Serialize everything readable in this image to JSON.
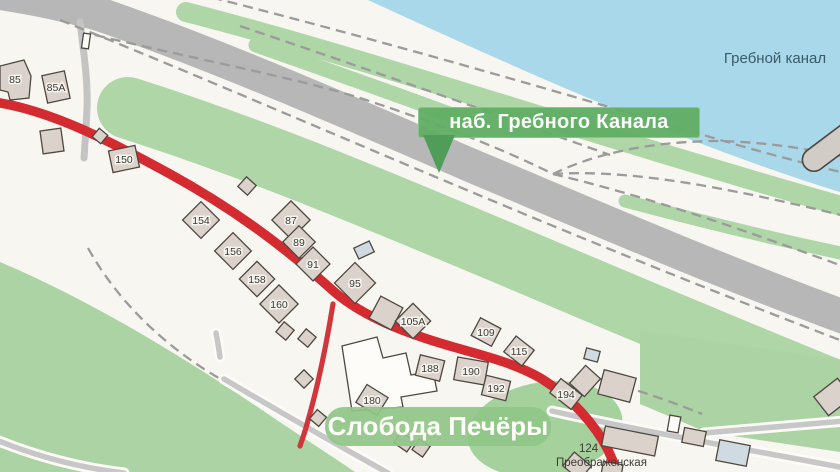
{
  "map": {
    "street_banner": "наб. Гребного Канала",
    "district_banner": "Слобода Печёры",
    "canal_label": "Гребной канал",
    "street_caption": {
      "line1": "124",
      "line2": "Преображенская"
    }
  },
  "colors": {
    "paper": "#f7f6f1",
    "water": "#a8d8ea",
    "green_base": "#abd3a3",
    "green_strip": "#afd6a7",
    "green_blob": "#a5d19c",
    "road_major": "#b7b7b7",
    "road_minor": "#c7c7c7",
    "road_casing": "#fcfbf7",
    "path_dash": "#9b9b9b",
    "road_red": "#d42b30",
    "road_red_minor": "#d0373c",
    "building_fill": "#dbd3cb",
    "building_stroke": "#4e4740",
    "building_blue": "#cfdae3",
    "building_white": "#fdfcf8",
    "pontoon_fill": "#d2ccc7",
    "banner_green": "#61ae64",
    "banner_arrow": "#4f9d58",
    "district_green": "rgba(143,198,136,0.92)",
    "number_text": "#3c3933",
    "canal_text": "#3d5a68"
  },
  "buildings": [
    {
      "type": "poly",
      "pts": "0,66 24,60 31,76 29,98 10,100 8,92 0,90",
      "label": "85",
      "lx": 15,
      "ly": 79
    },
    {
      "x": 56,
      "y": 87,
      "w": 23,
      "h": 28,
      "r": -12,
      "label": "85A"
    },
    {
      "x": 86,
      "y": 41,
      "w": 7,
      "h": 15,
      "r": 8,
      "f": "w"
    },
    {
      "x": 52,
      "y": 141,
      "w": 21,
      "h": 23,
      "r": -8
    },
    {
      "x": 100,
      "y": 136,
      "w": 11,
      "h": 11,
      "r": 40
    },
    {
      "x": 124,
      "y": 159,
      "w": 27,
      "h": 22,
      "r": -12,
      "label": "150"
    },
    {
      "x": 247,
      "y": 186,
      "w": 13,
      "h": 13,
      "r": 42
    },
    {
      "x": 201,
      "y": 220,
      "w": 26,
      "h": 26,
      "r": 45,
      "label": "154"
    },
    {
      "x": 233,
      "y": 251,
      "w": 26,
      "h": 26,
      "r": 45,
      "label": "156"
    },
    {
      "x": 257,
      "y": 279,
      "w": 25,
      "h": 25,
      "r": 45,
      "label": "158"
    },
    {
      "x": 279,
      "y": 304,
      "w": 27,
      "h": 27,
      "r": 45,
      "label": "160"
    },
    {
      "x": 291,
      "y": 220,
      "w": 27,
      "h": 27,
      "r": 45,
      "label": "87"
    },
    {
      "x": 299,
      "y": 242,
      "w": 23,
      "h": 23,
      "r": 45,
      "label": "89"
    },
    {
      "x": 313,
      "y": 264,
      "w": 24,
      "h": 24,
      "r": 45,
      "label": "91"
    },
    {
      "x": 355,
      "y": 283,
      "w": 29,
      "h": 29,
      "r": 45,
      "label": "95"
    },
    {
      "x": 364,
      "y": 250,
      "w": 17,
      "h": 12,
      "r": -25,
      "f": "g"
    },
    {
      "x": 386,
      "y": 313,
      "w": 25,
      "h": 25,
      "r": 28
    },
    {
      "x": 413,
      "y": 321,
      "w": 25,
      "h": 25,
      "r": 45,
      "label": "105A"
    },
    {
      "x": 486,
      "y": 332,
      "w": 23,
      "h": 20,
      "r": 28,
      "label": "109"
    },
    {
      "x": 519,
      "y": 351,
      "w": 23,
      "h": 20,
      "r": 38,
      "label": "115"
    },
    {
      "type": "poly",
      "pts": "342,346 377,337 383,358 406,353 411,375 433,371 437,391 401,397 403,407 352,411",
      "f": "w"
    },
    {
      "x": 430,
      "y": 368,
      "w": 25,
      "h": 21,
      "r": 14,
      "label": "188"
    },
    {
      "x": 471,
      "y": 371,
      "w": 31,
      "h": 23,
      "r": 10,
      "label": "190"
    },
    {
      "x": 496,
      "y": 388,
      "w": 25,
      "h": 20,
      "r": 14,
      "label": "192"
    },
    {
      "x": 566,
      "y": 394,
      "w": 27,
      "h": 18,
      "r": 38,
      "label": "194"
    },
    {
      "x": 372,
      "y": 400,
      "w": 25,
      "h": 21,
      "r": 32,
      "label": "180"
    },
    {
      "x": 285,
      "y": 331,
      "w": 13,
      "h": 13,
      "r": 40
    },
    {
      "x": 307,
      "y": 338,
      "w": 13,
      "h": 13,
      "r": 40
    },
    {
      "x": 304,
      "y": 379,
      "w": 13,
      "h": 13,
      "r": 45
    },
    {
      "x": 318,
      "y": 418,
      "w": 12,
      "h": 12,
      "r": 40
    },
    {
      "x": 404,
      "y": 442,
      "w": 16,
      "h": 13,
      "r": 35
    },
    {
      "x": 421,
      "y": 448,
      "w": 13,
      "h": 13,
      "r": 35
    },
    {
      "x": 592,
      "y": 355,
      "w": 14,
      "h": 11,
      "r": 15,
      "f": "g"
    },
    {
      "x": 585,
      "y": 381,
      "w": 20,
      "h": 24,
      "r": 42
    },
    {
      "x": 617,
      "y": 386,
      "w": 33,
      "h": 25,
      "r": 15
    },
    {
      "x": 674,
      "y": 424,
      "w": 11,
      "h": 16,
      "r": 10,
      "f": "w"
    },
    {
      "x": 630,
      "y": 441,
      "w": 54,
      "h": 20,
      "r": 11
    },
    {
      "x": 694,
      "y": 437,
      "w": 22,
      "h": 15,
      "r": 11
    },
    {
      "x": 733,
      "y": 453,
      "w": 31,
      "h": 21,
      "r": 11,
      "f": "g"
    },
    {
      "x": 833,
      "y": 397,
      "w": 30,
      "h": 24,
      "r": -38
    },
    {
      "x": 577,
      "y": 466,
      "w": 22,
      "h": 18,
      "r": 40
    },
    {
      "x": 612,
      "y": 470,
      "w": 20,
      "h": 14,
      "r": 10
    }
  ]
}
